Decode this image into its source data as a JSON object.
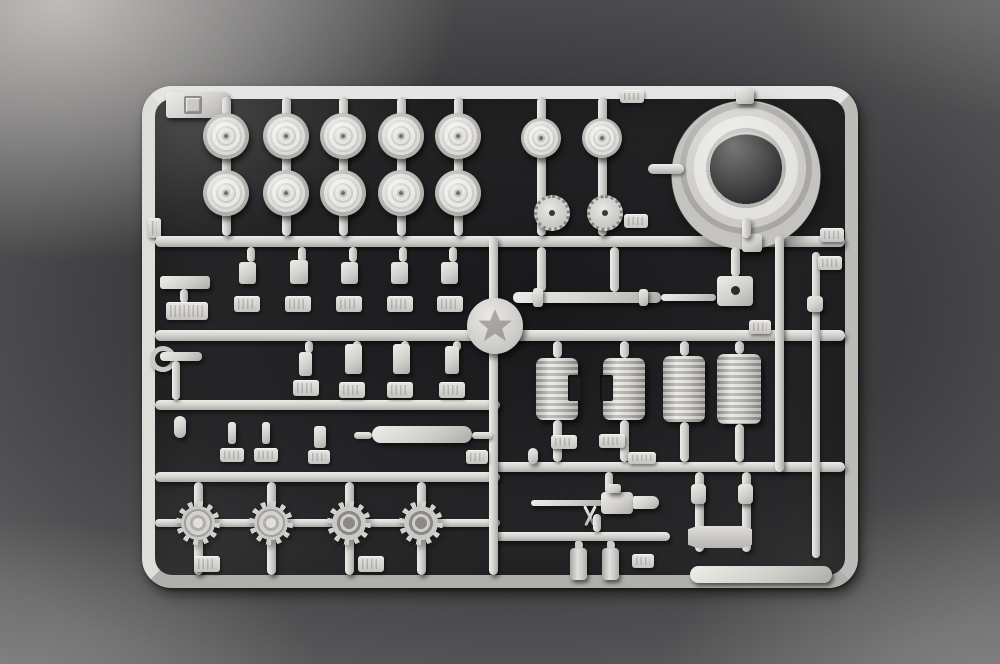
{
  "scene": {
    "type": "photograph",
    "subject": "injection-molded styrene model-kit sprue with tank parts on a dark grained surface",
    "visible_text": "none legible; embossed part-number tabs, corner letter tab and maker logo disc are present but unreadable",
    "colors": {
      "plastic": "#d2d0cc",
      "plastic_hi": "#eeede9",
      "plastic_lo": "#aeaca8",
      "surface": "#49494b",
      "surface_light": "#c4c1bd",
      "interior": "#0a0a0c"
    },
    "parts_inventory": {
      "road_wheels_large": 10,
      "road_wheels_small": 2,
      "perforated_discs": 2,
      "turret_ring": 1,
      "drive_sprockets": 4,
      "fuel_drums": 4,
      "machine_gun": 1,
      "long_barrel_rod": 1,
      "axle_rod": 1,
      "muffler": 1,
      "small_bottles": 2,
      "tow_bracket": 1,
      "small_fittings": 16,
      "part_number_tabs": 22,
      "maker_logo_disc": 1,
      "corner_letter_tab": 1
    }
  }
}
